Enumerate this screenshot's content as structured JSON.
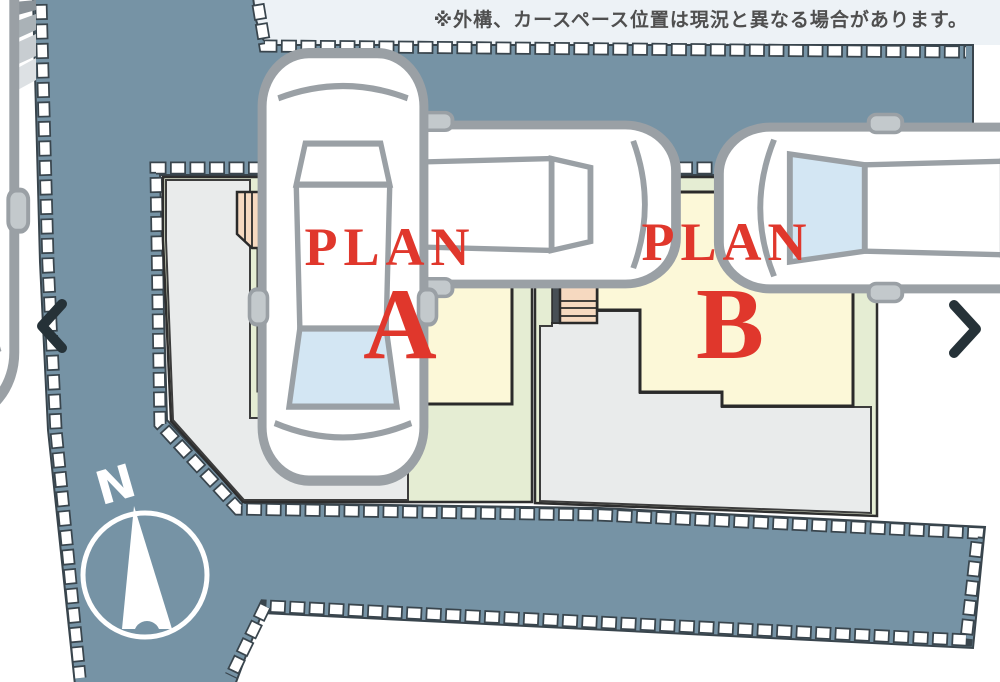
{
  "banner": {
    "text": "※外構、カースペース位置は現況と異なる場合があります。"
  },
  "site_plan": {
    "plans": [
      {
        "id": "A",
        "label": "PLAN",
        "letter": "A"
      },
      {
        "id": "B",
        "label": "PLAN",
        "letter": "B"
      }
    ],
    "compass": {
      "label": "N"
    },
    "cars_count": 4
  },
  "nav": {
    "prev_icon": "chevron-left",
    "next_icon": "chevron-right"
  },
  "colors": {
    "road": "#7693a5",
    "road_edge": "#39454d",
    "plot": "#e5edd3",
    "building": "#fcf8d8",
    "porch": "#f6d9c0",
    "porch_dark": "#474f55",
    "driveway": "#e9ebeb",
    "plan_red": "#e0372c",
    "banner_text": "#4f4f4f",
    "chevron": "#263238",
    "car_line": "#9aa0a5",
    "car_glass": "#d3e6f3"
  }
}
